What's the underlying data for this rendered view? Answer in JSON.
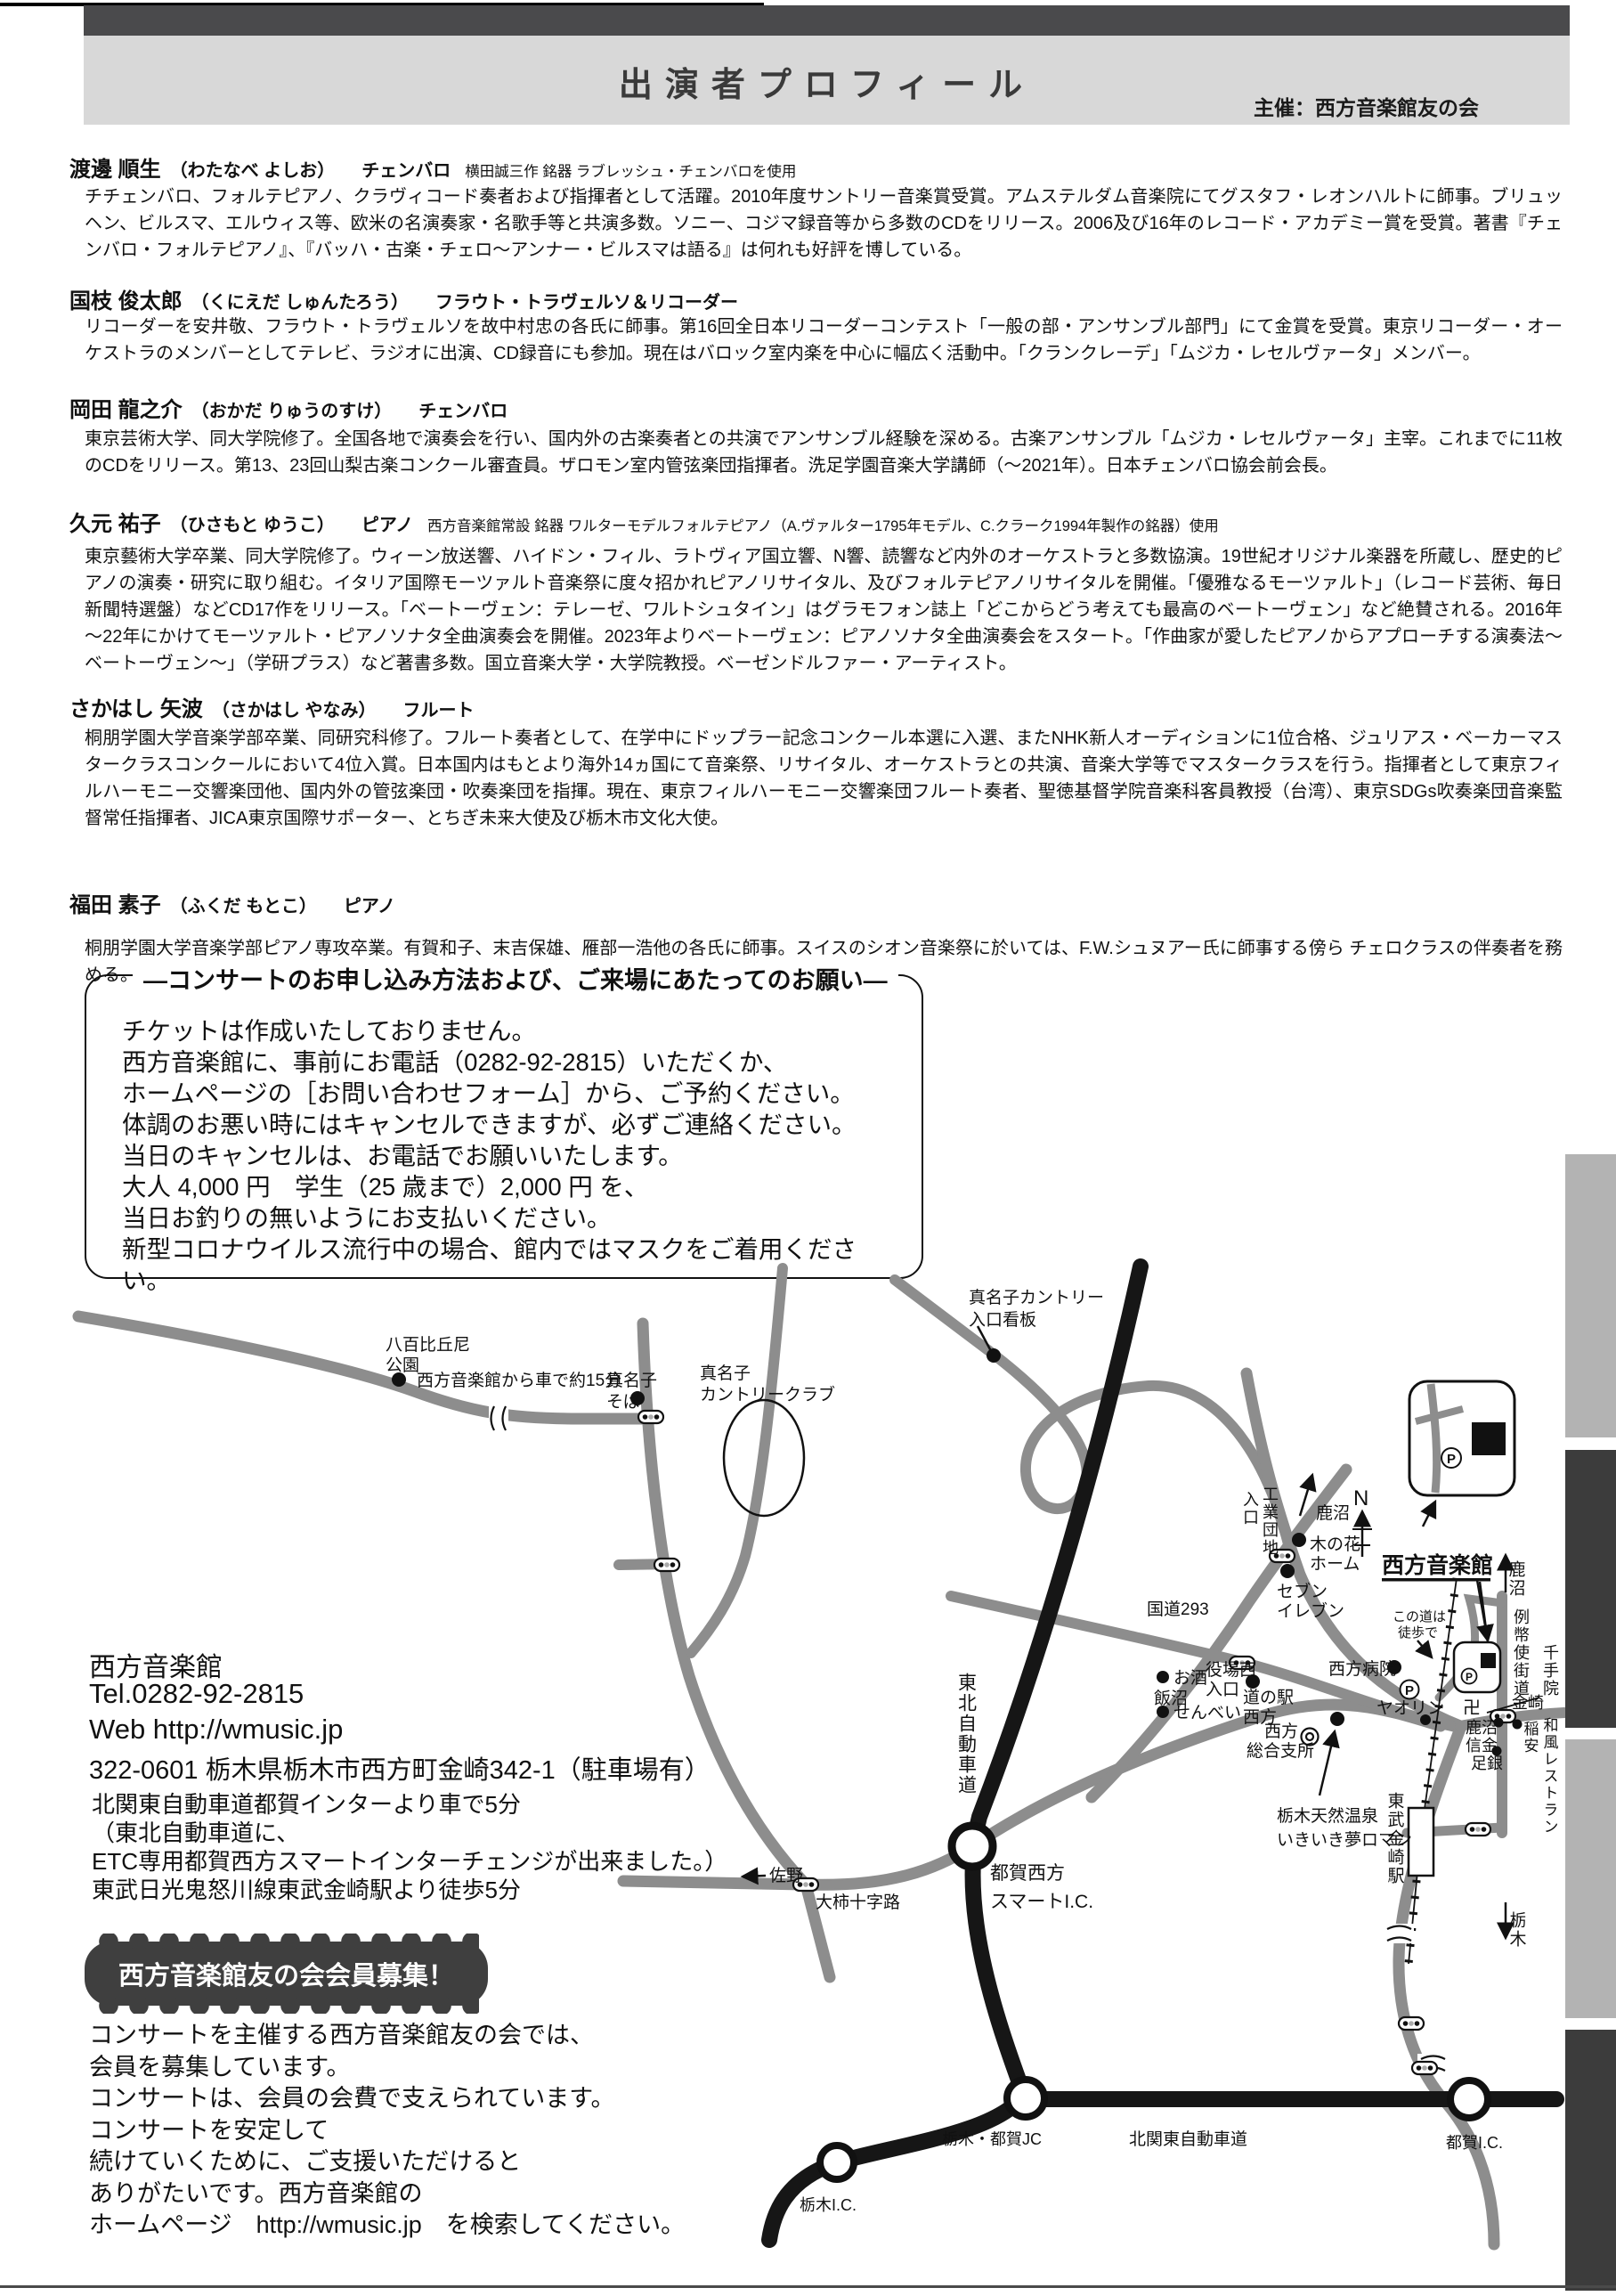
{
  "header": {
    "title": "出演者プロフィール",
    "organizer": "主催：西方音楽館友の会"
  },
  "profiles": [
    {
      "name": "渡邊 順生",
      "reading": "（わたなべ よしお）",
      "instrument": "チェンバロ",
      "annotation": "横田誠三作 銘器 ラブレッシュ・チェンバロを使用",
      "bio": "チチェンバロ、フォルテピアノ、クラヴィコード奏者および指揮者として活躍。2010年度サントリー音楽賞受賞。アムステルダム音楽院にてグスタフ・レオンハルトに師事。ブリュッヘン、ビルスマ、エルウィス等、欧米の名演奏家・名歌手等と共演多数。ソニー、コジマ録音等から多数のCDをリリース。2006及び16年のレコード・アカデミー賞を受賞。著書『チェンバロ・フォルテピアノ』、『バッハ・古楽・チェロ～アンナー・ビルスマは語る』は何れも好評を博している。"
    },
    {
      "name": "国枝 俊太郎",
      "reading": "（くにえだ しゅんたろう）",
      "instrument": "フラウト・トラヴェルソ＆リコーダー",
      "annotation": "",
      "bio": "リコーダーを安井敬、フラウト・トラヴェルソを故中村忠の各氏に師事。第16回全日本リコーダーコンテスト「一般の部・アンサンブル部門」にて金賞を受賞。東京リコーダー・オーケストラのメンバーとしてテレビ、ラジオに出演、CD録音にも参加。現在はバロック室内楽を中心に幅広く活動中。「クランクレーデ」「ムジカ・レセルヴァータ」メンバー。"
    },
    {
      "name": "岡田 龍之介",
      "reading": "（おかだ りゅうのすけ）",
      "instrument": "チェンバロ",
      "annotation": "",
      "bio": "東京芸術大学、同大学院修了。全国各地で演奏会を行い、国内外の古楽奏者との共演でアンサンブル経験を深める。古楽アンサンブル「ムジカ・レセルヴァータ」主宰。これまでに11枚のCDをリリース。第13、23回山梨古楽コンクール審査員。ザロモン室内管弦楽団指揮者。洗足学園音楽大学講師（～2021年）。日本チェンバロ協会前会長。"
    },
    {
      "name": "久元 祐子",
      "reading": "（ひさもと ゆうこ）",
      "instrument": "ピアノ",
      "annotation": "西方音楽館常設 銘器 ワルターモデルフォルテピアノ（A.ヴァルター1795年モデル、C.クラーク1994年製作の銘器）使用",
      "bio": "東京藝術大学卒業、同大学院修了。ウィーン放送響、ハイドン・フィル、ラトヴィア国立響、N響、読響など内外のオーケストラと多数協演。19世紀オリジナル楽器を所蔵し、歴史的ピアノの演奏・研究に取り組む。イタリア国際モーツァルト音楽祭に度々招かれピアノリサイタル、及びフォルテピアノリサイタルを開催。「優雅なるモーツァルト」（レコード芸術、毎日新聞特選盤）などCD17作をリリース。「ベートーヴェン：テレーゼ、ワルトシュタイン」はグラモフォン誌上「どこからどう考えても最高のベートーヴェン」など絶賛される。2016年～22年にかけてモーツァルト・ピアノソナタ全曲演奏会を開催。2023年よりベートーヴェン：ピアノソナタ全曲演奏会をスタート。「作曲家が愛したピアノからアプローチする演奏法～ベートーヴェン～」（学研プラス）など著書多数。国立音楽大学・大学院教授。ベーゼンドルファー・アーティスト。"
    },
    {
      "name": "さかはし 矢波",
      "reading": "（さかはし やなみ）",
      "instrument": "フルート",
      "annotation": "",
      "bio": "桐朋学園大学音楽学部卒業、同研究科修了。フルート奏者として、在学中にドップラー記念コンクール本選に入選、またNHK新人オーディションに1位合格、ジュリアス・ベーカーマスタークラスコンクールにおいて4位入賞。日本国内はもとより海外14ヵ国にて音楽祭、リサイタル、オーケストラとの共演、音楽大学等でマスタークラスを行う。指揮者として東京フィルハーモニー交響楽団他、国内外の管弦楽団・吹奏楽団を指揮。現在、東京フィルハーモニー交響楽団フルート奏者、聖徳基督学院音楽科客員教授（台湾）、東京SDGs吹奏楽団音楽監督常任指揮者、JICA東京国際サポーター、とちぎ未来大使及び栃木市文化大使。"
    },
    {
      "name": "福田 素子",
      "reading": "（ふくだ もとこ）",
      "instrument": "ピアノ",
      "annotation": "",
      "bio": "桐朋学園大学音楽学部ピアノ専攻卒業。有賀和子、末吉保雄、雁部一浩他の各氏に師事。スイスのシオン音楽祭に於いては、F.W.シュヌアー氏に師事する傍ら チェロクラスの伴奏者を務める。これまでリサイタルをはじめテレビ・ラジオ出演など、国内外の演奏家と多数共演。"
    }
  ],
  "notice_box": {
    "title": "―コンサートのお申し込み方法および、ご来場にあたってのお願い―",
    "lines": [
      "チケットは作成いたしておりません。",
      "西方音楽館に、事前にお電話（0282-92-2815）いただくか、",
      "ホームページの［お問い合わせフォーム］から、ご予約ください。",
      "体調のお悪い時にはキャンセルできますが、必ずご連絡ください。",
      "当日のキャンセルは、お電話でお願いいたします。",
      "大人 4,000 円　学生（25 歳まで）2,000 円 を、",
      "当日お釣りの無いようにお支払いください。",
      "新型コロナウイルス流行中の場合、館内ではマスクをご着用ください。"
    ]
  },
  "contact": {
    "name": "西方音楽館",
    "tel": "Tel.0282-92-2815",
    "web": "Web http://wmusic.jp",
    "address": "322-0601 栃木県栃木市西方町金崎342-1（駐車場有）",
    "access": [
      "北関東自動車道都賀インターより車で5分",
      "（東北自動車道に、",
      "ETC専用都賀西方スマートインターチェンジが出来ました。）",
      "東武日光鬼怒川線東武金崎駅より徒歩5分"
    ]
  },
  "recruit": {
    "badge": "西方音楽館友の会会員募集！",
    "body_lines": [
      "コンサートを主催する西方音楽館友の会では、",
      "会員を募集しています。",
      "コンサートは、会員の会費で支えられています。",
      "コンサートを安定して",
      "続けていくために、ご支援いただけると",
      "ありがたいです。西方音楽館の",
      "ホームページ　http://wmusic.jp　を検索してください。"
    ]
  },
  "map": {
    "p_label": "P",
    "labels": {
      "yaobikuni1": "八百比丘尼",
      "yaobikuni2": "公園",
      "drive15": "西方音楽館から車で約15分",
      "manago_soba1": "真名子",
      "manago_soba2": "そば",
      "manago_cc1": "真名子",
      "manago_cc2": "カントリークラブ",
      "kanban1": "真名子カントリー",
      "kanban2": "入口看板",
      "kogyo1": "工業団地",
      "kogyo2": "入口",
      "kanuma_nw": "鹿沼",
      "n_mark": "N",
      "konohana1": "木の花",
      "konohana2": "ホーム",
      "seven1": "セブン",
      "seven2": "イレブン",
      "route293": "国道293",
      "music_hall": "西方音楽館",
      "konomichi1": "この道は",
      "konomichi2": "徒歩で",
      "hospital": "西方病院",
      "yaorin": "ヤオリン",
      "shisho1": "西方",
      "shisho2": "総合支所",
      "osake": "お酒",
      "iinuma": "飯沼",
      "senbei": "せんべい",
      "yakuba1": "役場西",
      "yakuba2": "入口",
      "michinoeki1": "道の駅",
      "michinoeki2": "西方",
      "onsen1": "栃木天然温泉",
      "onsen2": "いきいき夢ロマン",
      "tobu_station": "東武金崎駅",
      "kanuma_e": "鹿沼",
      "reiheishi": "例幣使街道",
      "senjuin": "千手院",
      "manji": "卍",
      "kanazaki": "金崎",
      "shinkin1": "鹿沼",
      "shinkin2": "信金",
      "inayasu": "稲安",
      "wafu": "和風レストラン",
      "ashigin": "足銀",
      "tochigi_s": "栃木",
      "tohoku_expwy": "東北自動車道",
      "sano": "佐野",
      "ogaki": "大柿十字路",
      "smart_ic1": "都賀西方",
      "smart_ic2": "スマートI.C.",
      "tochigi_ic": "栃木I.C.",
      "tochigi_tsuga_jc": "栃木・都賀JC",
      "kitakanto": "北関東自動車道",
      "tsuga_ic": "都賀I.C."
    }
  }
}
